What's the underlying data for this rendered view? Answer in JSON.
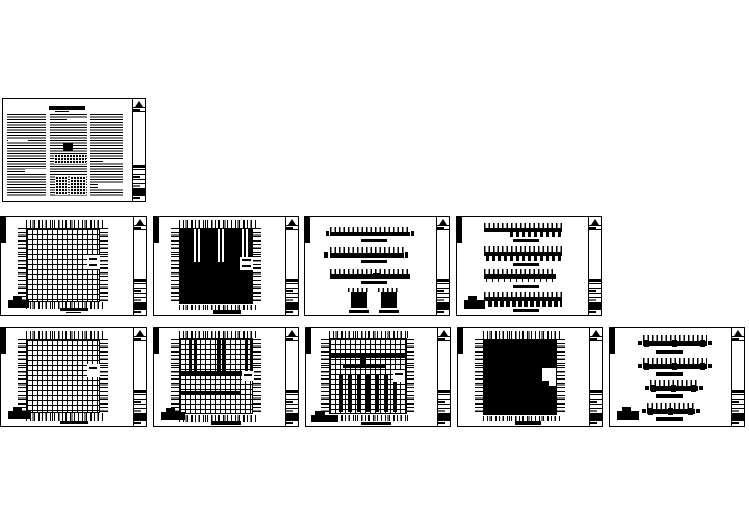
{
  "canvas": {
    "background": "#ffffff",
    "ink": "#000000"
  },
  "document_kind": "cad-drawing-set-preview",
  "sheet_count": 10,
  "sheets": [
    {
      "id": "sheet-01",
      "kind": "general-notes-sheet"
    },
    {
      "id": "sheet-02",
      "kind": "grid-plan-sheet"
    },
    {
      "id": "sheet-03",
      "kind": "filled-plan-sheet"
    },
    {
      "id": "sheet-04",
      "kind": "elevation-sheet"
    },
    {
      "id": "sheet-05",
      "kind": "elevation-sheet"
    },
    {
      "id": "sheet-06",
      "kind": "grid-plan-sheet"
    },
    {
      "id": "sheet-07",
      "kind": "grid-plan-with-bands-sheet"
    },
    {
      "id": "sheet-08",
      "kind": "grid-plan-with-columns-sheet"
    },
    {
      "id": "sheet-09",
      "kind": "filled-plan-sheet"
    },
    {
      "id": "sheet-10",
      "kind": "elevation-sheet"
    }
  ],
  "title_block": {
    "logo_icon": "triangle-logo",
    "text_legible": false
  },
  "drawing_text_legible": false
}
